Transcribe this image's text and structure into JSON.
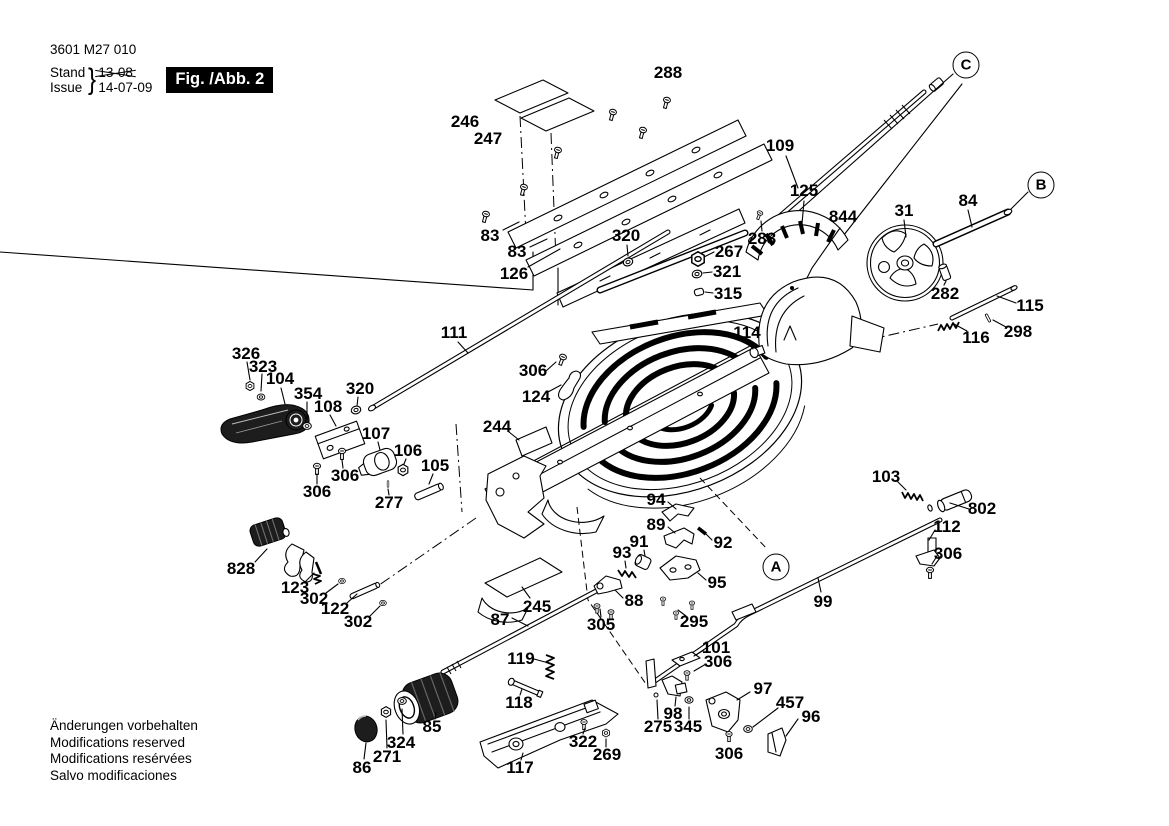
{
  "titleblock": {
    "part_number": "3601 M27 010",
    "stand_label": "Stand",
    "issue_label": "Issue",
    "brace": "}",
    "stand_date_struck": "13-08",
    "issue_date": "14-07-09",
    "figure_label": "Fig. /Abb. 2"
  },
  "footer": {
    "lines": [
      "Änderungen vorbehalten",
      "Modifications reserved",
      "Modifications resérvées",
      "Salvo modificaciones"
    ]
  },
  "colors": {
    "ink": "#000000",
    "background": "#ffffff"
  },
  "reference_circles": [
    {
      "text": "A",
      "x": 776,
      "y": 567
    },
    {
      "text": "B",
      "x": 1041,
      "y": 185
    },
    {
      "text": "C",
      "x": 966,
      "y": 65
    }
  ],
  "callouts": [
    {
      "text": "288",
      "x": 668,
      "y": 73
    },
    {
      "text": "246",
      "x": 465,
      "y": 122
    },
    {
      "text": "247",
      "x": 488,
      "y": 139
    },
    {
      "text": "109",
      "x": 780,
      "y": 146
    },
    {
      "text": "125",
      "x": 804,
      "y": 191
    },
    {
      "text": "844",
      "x": 843,
      "y": 217
    },
    {
      "text": "31",
      "x": 904,
      "y": 211
    },
    {
      "text": "84",
      "x": 968,
      "y": 201
    },
    {
      "text": "283",
      "x": 762,
      "y": 239
    },
    {
      "text": "83",
      "x": 490,
      "y": 236
    },
    {
      "text": "83",
      "x": 517,
      "y": 252
    },
    {
      "text": "320",
      "x": 626,
      "y": 236
    },
    {
      "text": "126",
      "x": 514,
      "y": 274
    },
    {
      "text": "267",
      "x": 729,
      "y": 252
    },
    {
      "text": "321",
      "x": 727,
      "y": 272
    },
    {
      "text": "315",
      "x": 728,
      "y": 294
    },
    {
      "text": "282",
      "x": 945,
      "y": 294
    },
    {
      "text": "115",
      "x": 1030,
      "y": 306
    },
    {
      "text": "116",
      "x": 976,
      "y": 338
    },
    {
      "text": "298",
      "x": 1018,
      "y": 332
    },
    {
      "text": "111",
      "x": 454,
      "y": 333
    },
    {
      "text": "114",
      "x": 747,
      "y": 333
    },
    {
      "text": "306",
      "x": 533,
      "y": 371
    },
    {
      "text": "124",
      "x": 536,
      "y": 397
    },
    {
      "text": "326",
      "x": 246,
      "y": 354
    },
    {
      "text": "323",
      "x": 263,
      "y": 367
    },
    {
      "text": "104",
      "x": 280,
      "y": 379
    },
    {
      "text": "354",
      "x": 308,
      "y": 394
    },
    {
      "text": "108",
      "x": 328,
      "y": 407
    },
    {
      "text": "320",
      "x": 360,
      "y": 389
    },
    {
      "text": "107",
      "x": 376,
      "y": 434
    },
    {
      "text": "106",
      "x": 408,
      "y": 451
    },
    {
      "text": "105",
      "x": 435,
      "y": 466
    },
    {
      "text": "306",
      "x": 345,
      "y": 476
    },
    {
      "text": "306",
      "x": 317,
      "y": 492
    },
    {
      "text": "277",
      "x": 389,
      "y": 503
    },
    {
      "text": "244",
      "x": 497,
      "y": 427
    },
    {
      "text": "94",
      "x": 656,
      "y": 500
    },
    {
      "text": "89",
      "x": 656,
      "y": 525
    },
    {
      "text": "91",
      "x": 639,
      "y": 542
    },
    {
      "text": "92",
      "x": 723,
      "y": 543
    },
    {
      "text": "93",
      "x": 622,
      "y": 553
    },
    {
      "text": "95",
      "x": 717,
      "y": 583
    },
    {
      "text": "88",
      "x": 634,
      "y": 601
    },
    {
      "text": "103",
      "x": 886,
      "y": 477
    },
    {
      "text": "802",
      "x": 982,
      "y": 509
    },
    {
      "text": "112",
      "x": 947,
      "y": 527
    },
    {
      "text": "306",
      "x": 948,
      "y": 554
    },
    {
      "text": "99",
      "x": 823,
      "y": 602
    },
    {
      "text": "828",
      "x": 241,
      "y": 569
    },
    {
      "text": "123",
      "x": 295,
      "y": 588
    },
    {
      "text": "302",
      "x": 314,
      "y": 599
    },
    {
      "text": "122",
      "x": 335,
      "y": 609
    },
    {
      "text": "302",
      "x": 358,
      "y": 622
    },
    {
      "text": "245",
      "x": 537,
      "y": 607
    },
    {
      "text": "87",
      "x": 500,
      "y": 620
    },
    {
      "text": "305",
      "x": 601,
      "y": 625
    },
    {
      "text": "295",
      "x": 694,
      "y": 622
    },
    {
      "text": "119",
      "x": 521,
      "y": 659
    },
    {
      "text": "101",
      "x": 716,
      "y": 648
    },
    {
      "text": "306",
      "x": 718,
      "y": 662
    },
    {
      "text": "118",
      "x": 519,
      "y": 703
    },
    {
      "text": "98",
      "x": 673,
      "y": 714
    },
    {
      "text": "97",
      "x": 763,
      "y": 689
    },
    {
      "text": "275",
      "x": 658,
      "y": 727
    },
    {
      "text": "345",
      "x": 688,
      "y": 727
    },
    {
      "text": "457",
      "x": 790,
      "y": 703
    },
    {
      "text": "96",
      "x": 811,
      "y": 717
    },
    {
      "text": "306",
      "x": 729,
      "y": 754
    },
    {
      "text": "85",
      "x": 432,
      "y": 727
    },
    {
      "text": "324",
      "x": 401,
      "y": 743
    },
    {
      "text": "271",
      "x": 387,
      "y": 757
    },
    {
      "text": "86",
      "x": 362,
      "y": 768
    },
    {
      "text": "117",
      "x": 520,
      "y": 768
    },
    {
      "text": "322",
      "x": 583,
      "y": 742
    },
    {
      "text": "269",
      "x": 607,
      "y": 755
    }
  ]
}
